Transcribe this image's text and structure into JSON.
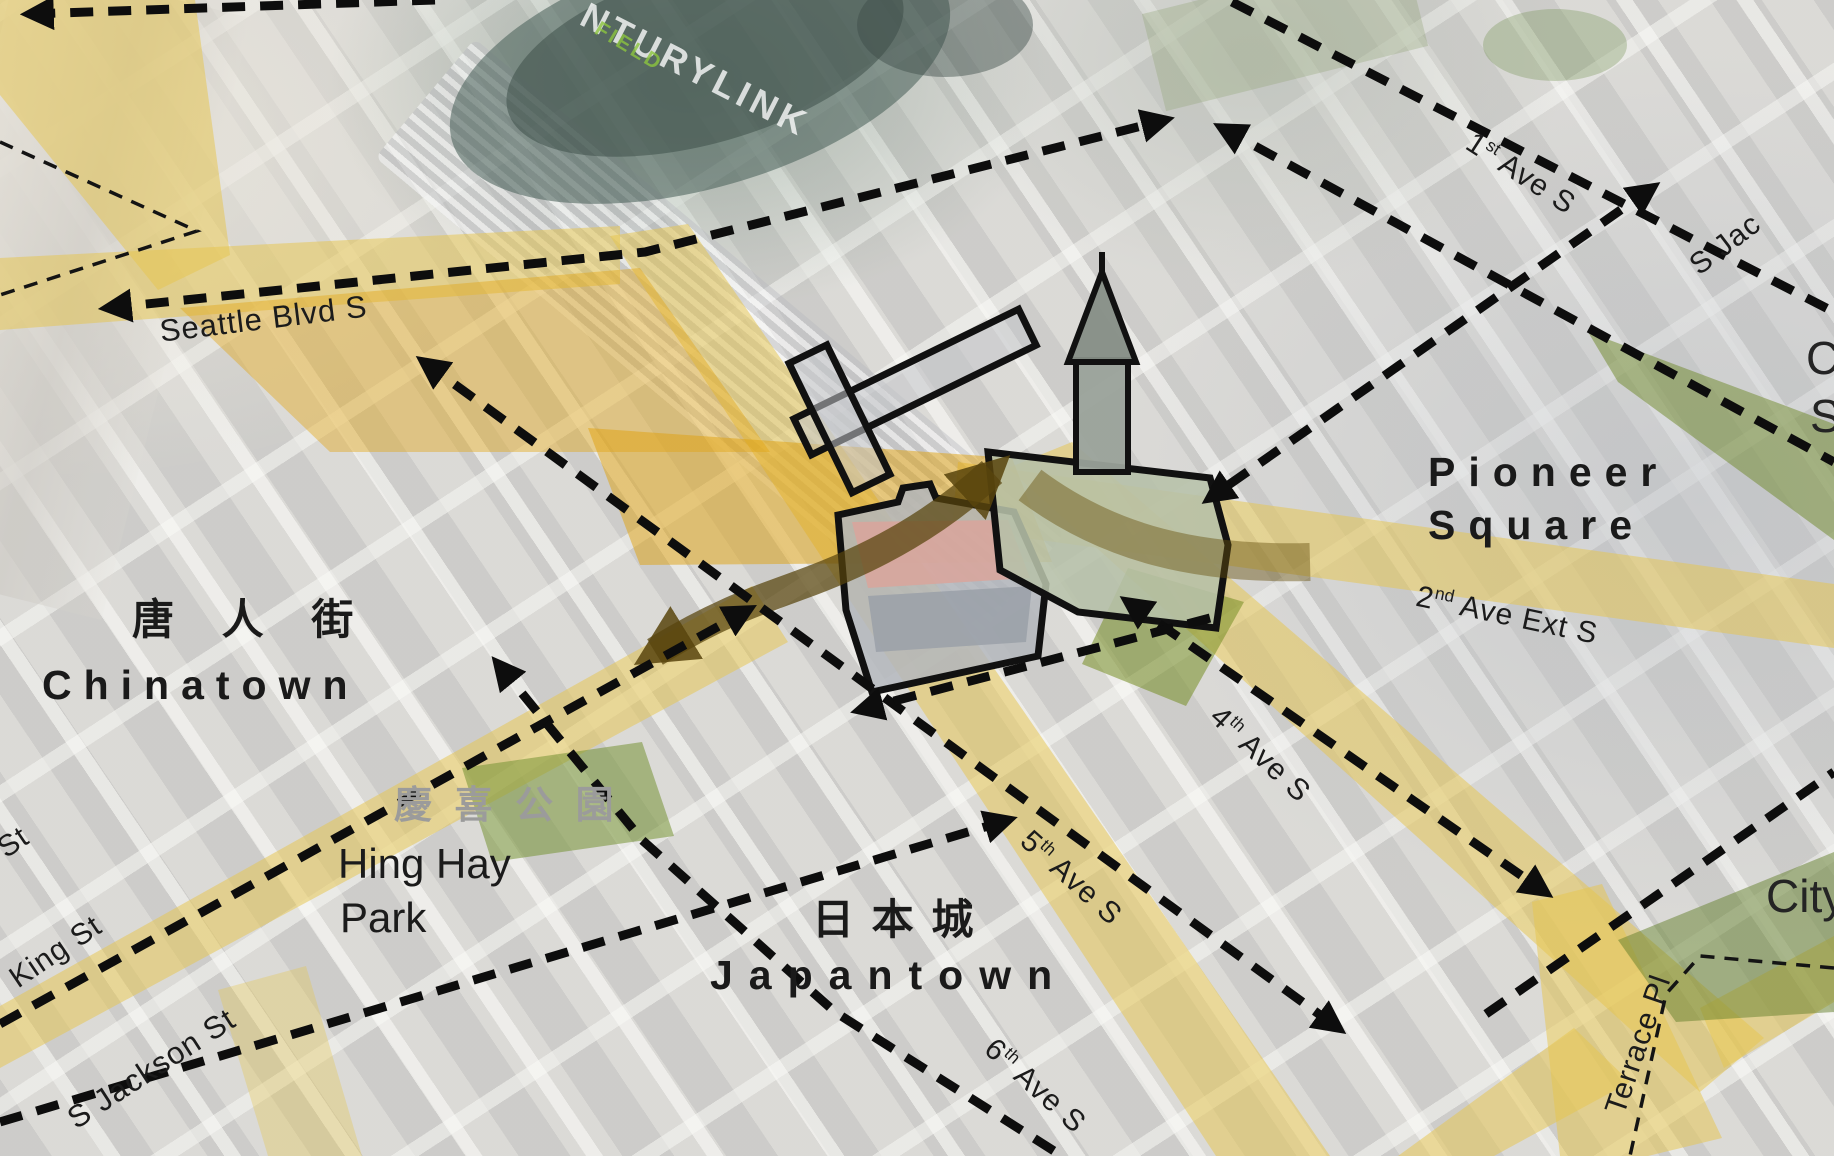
{
  "diagram": {
    "neighborhoods": {
      "chinatown": {
        "cjk": "唐 人 街",
        "name": "Chinatown"
      },
      "japantown": {
        "cjk": "日 本 城",
        "name": "Japantown"
      },
      "pioneer_square": {
        "line1": "Pioneer",
        "line2": "Square"
      },
      "hing_hay_park": {
        "cjk": "慶 喜 公 園",
        "line1": "Hing Hay",
        "line2": "Park"
      }
    },
    "streets": {
      "seattle_blvd": "Seattle Blvd S",
      "king_st": "King St",
      "s_jackson_st": "S Jackson St",
      "terrace_pl": "Terrace Pl",
      "first_ave": {
        "num": "1",
        "sup": "st",
        "rest": " Ave S"
      },
      "second_ave_ext": {
        "num": "2",
        "sup": "nd",
        "rest": " Ave Ext S"
      },
      "fourth_ave": {
        "num": "4",
        "sup": "th",
        "rest": " Ave S"
      },
      "fifth_ave": {
        "num": "5",
        "sup": "th",
        "rest": " Ave S"
      },
      "sixth_ave": {
        "num": "6",
        "sup": "th",
        "rest": " Ave S"
      }
    },
    "partial_labels": {
      "street_st": "St",
      "s_jackson_ne": "S Jac",
      "right_edge_top": "C",
      "right_edge_bottom": "S",
      "city": "City"
    },
    "stadium": {
      "name_fragment": "NTURYLINK",
      "field": "FIELD"
    },
    "colors": {
      "route_yellow": "#e6c64e",
      "plaza_orange": "#dfa316",
      "movement_arrow_dark": "#5c470e",
      "open_space_green": "#7a9434",
      "arrow_black": "#0d0d0d",
      "cjk_label_gray": "#9b9b9b"
    }
  }
}
